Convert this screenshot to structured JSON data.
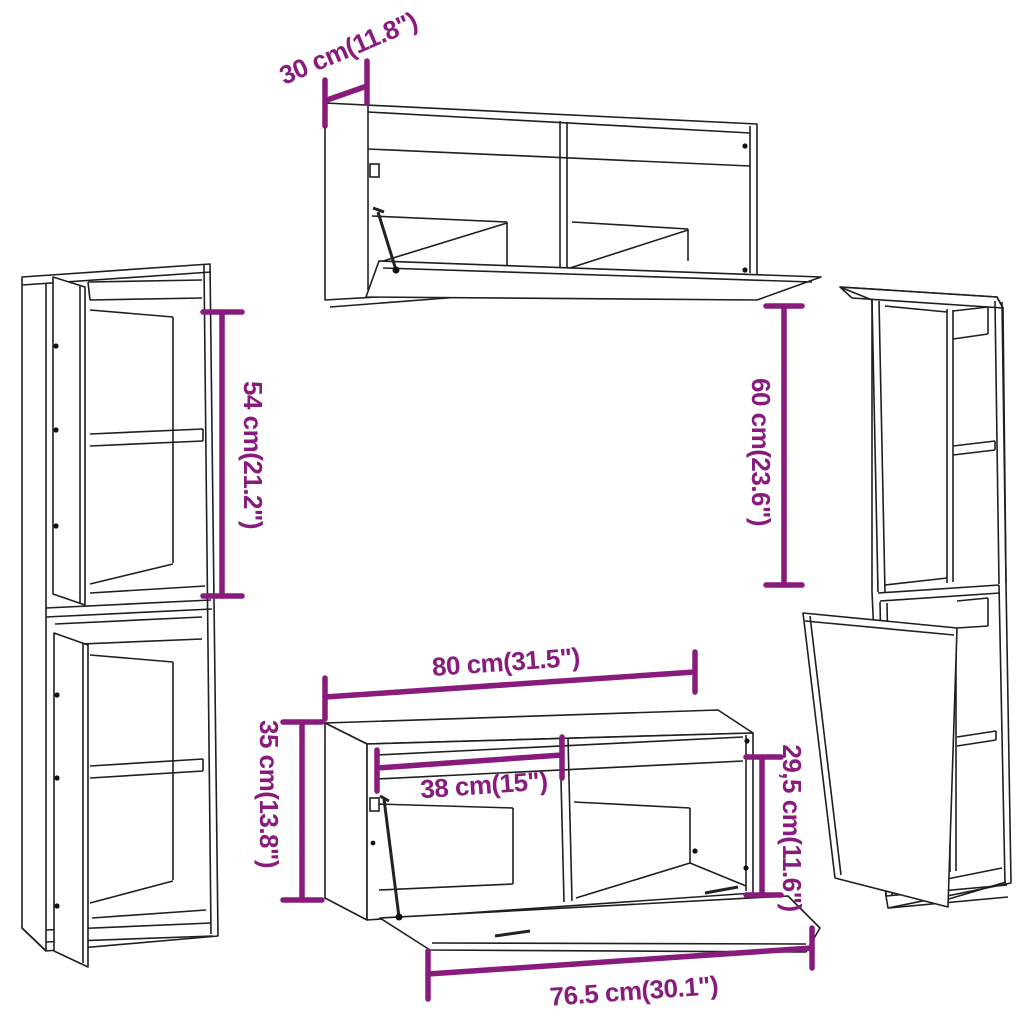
{
  "diagram": {
    "kind": "furniture-dimension-diagram",
    "background": "#ffffff",
    "pieces": [
      "top wall cabinet with open flap door",
      "left tall cabinet upper unit with open door",
      "left tall cabinet lower unit with open door",
      "right tall cabinet upper unit open side",
      "right tall cabinet lower unit with open door",
      "tv bench with open flap door"
    ]
  },
  "colors": {
    "dimension_accent": "#881b7c",
    "line": "#1f1f1f"
  },
  "dims": {
    "d30": {
      "label": "30 cm(11.8\")"
    },
    "d54": {
      "label": "54 cm(21.2\")"
    },
    "d35": {
      "label": "35 cm(13.8\")"
    },
    "d60": {
      "label": "60 cm(23.6\")"
    },
    "d80": {
      "label": "80 cm(31.5\")"
    },
    "d38": {
      "label": "38 cm(15\")"
    },
    "d29": {
      "label": "29,5 cm(11.6\")"
    },
    "d76": {
      "label": "76.5 cm(30.1\")"
    }
  }
}
